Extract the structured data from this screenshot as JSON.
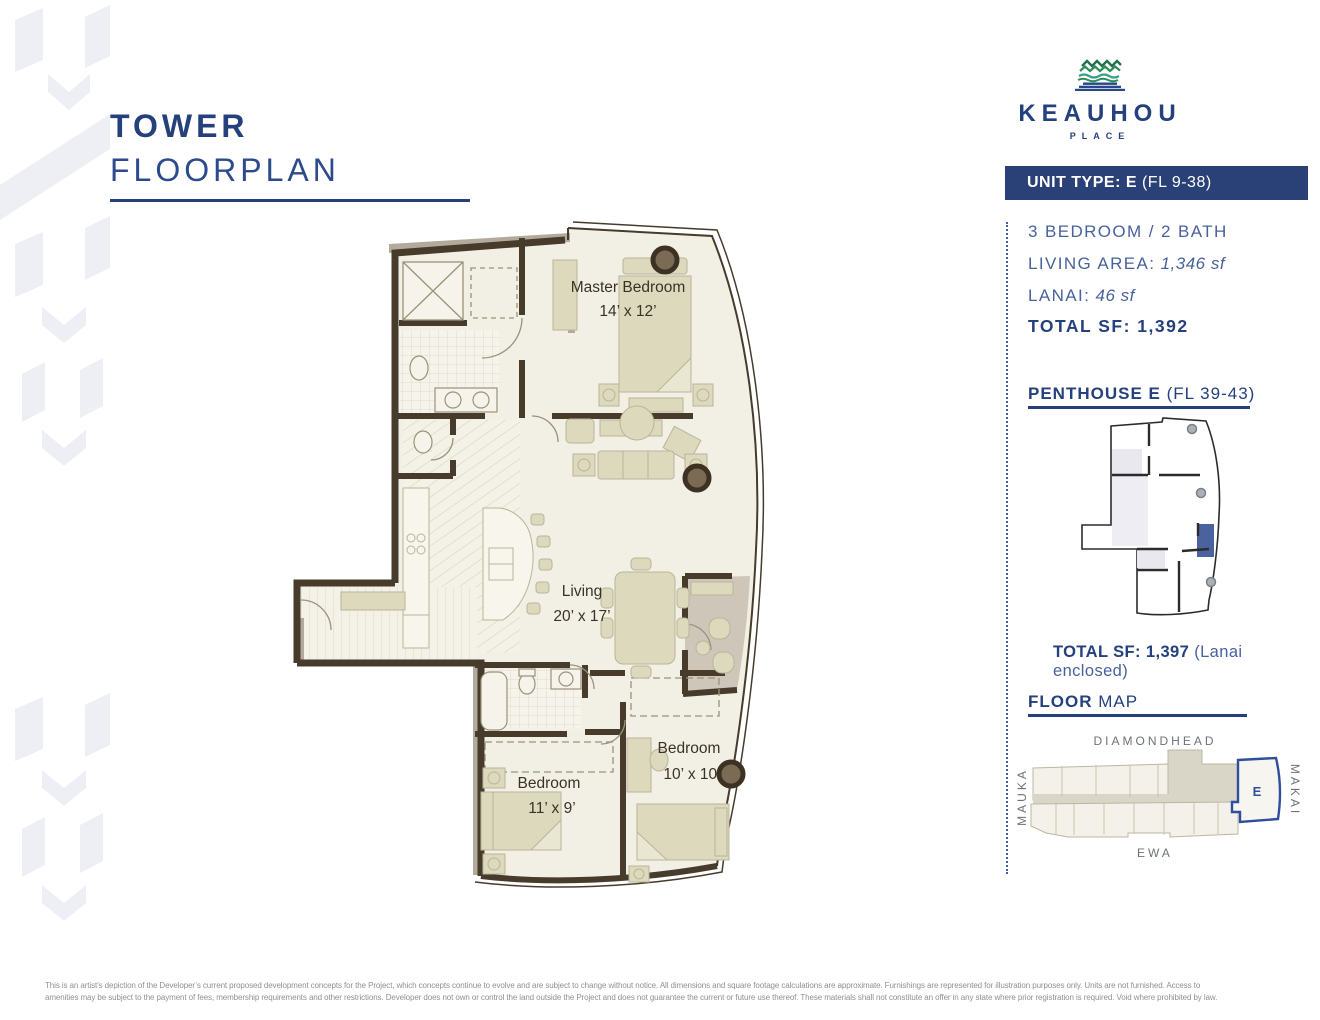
{
  "header": {
    "title_bold": "TOWER",
    "title_light": "FLOORPLAN"
  },
  "logo": {
    "name": "KEAUHOU",
    "sub": "PLACE"
  },
  "unit_banner": {
    "bold": "UNIT TYPE: E",
    "rest": " (FL 9-38)"
  },
  "specs": {
    "bed_bath": "3 BEDROOM / 2 BATH",
    "living_label": "LIVING AREA:",
    "living_value": " 1,346 sf",
    "lanai_label": "LANAI:",
    "lanai_value": " 46 sf",
    "total": "TOTAL SF: 1,392"
  },
  "penthouse": {
    "title_bold": "PENTHOUSE E",
    "title_rest": " (FL 39-43)",
    "total_bold": "TOTAL SF: 1,397",
    "total_rest": " (Lanai enclosed)"
  },
  "floor_map": {
    "title_bold": "FLOOR",
    "title_rest": " MAP",
    "top": "DIAMONDHEAD",
    "left": "MAUKA",
    "right": "MAKAI",
    "bottom": "EWA",
    "unit": "E"
  },
  "floorplan": {
    "master_name": "Master Bedroom",
    "master_dims": "14’ x 12’",
    "living_name": "Living",
    "living_dims": "20’ x 17’",
    "bedroom1_name": "Bedroom",
    "bedroom1_dims": "11’ x 9’",
    "bedroom2_name": "Bedroom",
    "bedroom2_dims": "10’ x 10’"
  },
  "disclaimer": {
    "line1": "This is an artist’s depiction of the Developer’s current proposed development concepts for the Project, which concepts continue to evolve and are subject to change without notice. All dimensions and square footage calculations are approximate.  Furnishings are represented for illustration purposes only. Units are not furnished. Access to",
    "line2": "amenities may be subject to the payment of fees, membership requirements and other restrictions. Developer does not own or control the land outside the Project and does not guarantee the current or future use thereof. These materials shall not constitute an offer in any state where prior registration is required. Void where prohibited by law."
  },
  "colors": {
    "navy": "#24407d",
    "banner_navy": "#2a4177",
    "spec_blue": "#47629e",
    "accent_blue": "#2f4f9e",
    "logo_green_dark": "#23714b",
    "logo_green": "#2e8c5a",
    "logo_teal": "#35a184",
    "wall_brown": "#473b2b",
    "floor_cream": "#f2f0e4",
    "furniture_tan": "#dcd9bd",
    "lanai_taupe": "#cec6b8",
    "decor_gray": "#edeff5"
  }
}
